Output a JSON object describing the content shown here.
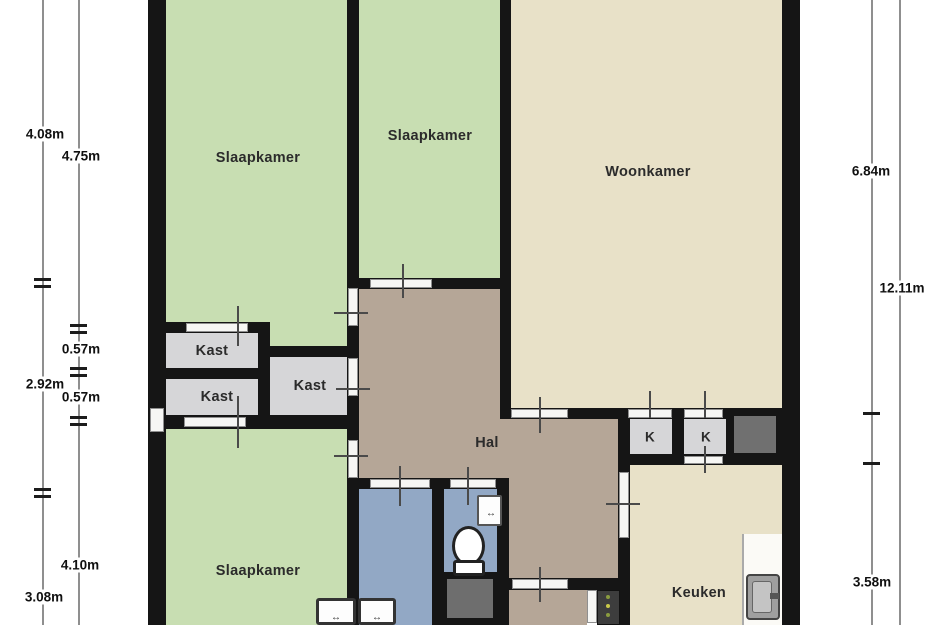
{
  "plan": {
    "title": "Floor plan (plattegrond)",
    "rooms": [
      {
        "id": "slaapkamer-1",
        "label": "Slaapkamer"
      },
      {
        "id": "slaapkamer-2",
        "label": "Slaapkamer"
      },
      {
        "id": "woonkamer",
        "label": "Woonkamer"
      },
      {
        "id": "kast-1",
        "label": "Kast"
      },
      {
        "id": "kast-2",
        "label": "Kast"
      },
      {
        "id": "kast-3",
        "label": "Kast"
      },
      {
        "id": "hal",
        "label": "Hal"
      },
      {
        "id": "k-closet-1",
        "label": "K"
      },
      {
        "id": "k-closet-2",
        "label": "K"
      },
      {
        "id": "keuken",
        "label": "Keuken"
      },
      {
        "id": "slaapkamer-3",
        "label": "Slaapkamer"
      }
    ],
    "dimensions": {
      "left_outer": [
        "4.08m",
        "2.92m",
        "3.08m"
      ],
      "left_inner": [
        "4.75m",
        "0.57m",
        "0.57m",
        "4.10m"
      ],
      "right_inner": [
        "6.84m",
        "3.58m"
      ],
      "right_outer": [
        "12.11m"
      ]
    },
    "fixtures": [
      "toilet",
      "hand-basin",
      "washer",
      "washer",
      "kitchen-sink",
      "meter-cabinet"
    ],
    "colors": {
      "bedroom_green": "#c8deb2",
      "living_beige": "#e8e1c8",
      "hall_taupe": "#b5a697",
      "closet_gray": "#d6d6d8",
      "bath_blue": "#92a8c5",
      "shaft_dark": "#707070",
      "wall_black": "#151515",
      "dimension_line": "#8f8f8f"
    }
  }
}
